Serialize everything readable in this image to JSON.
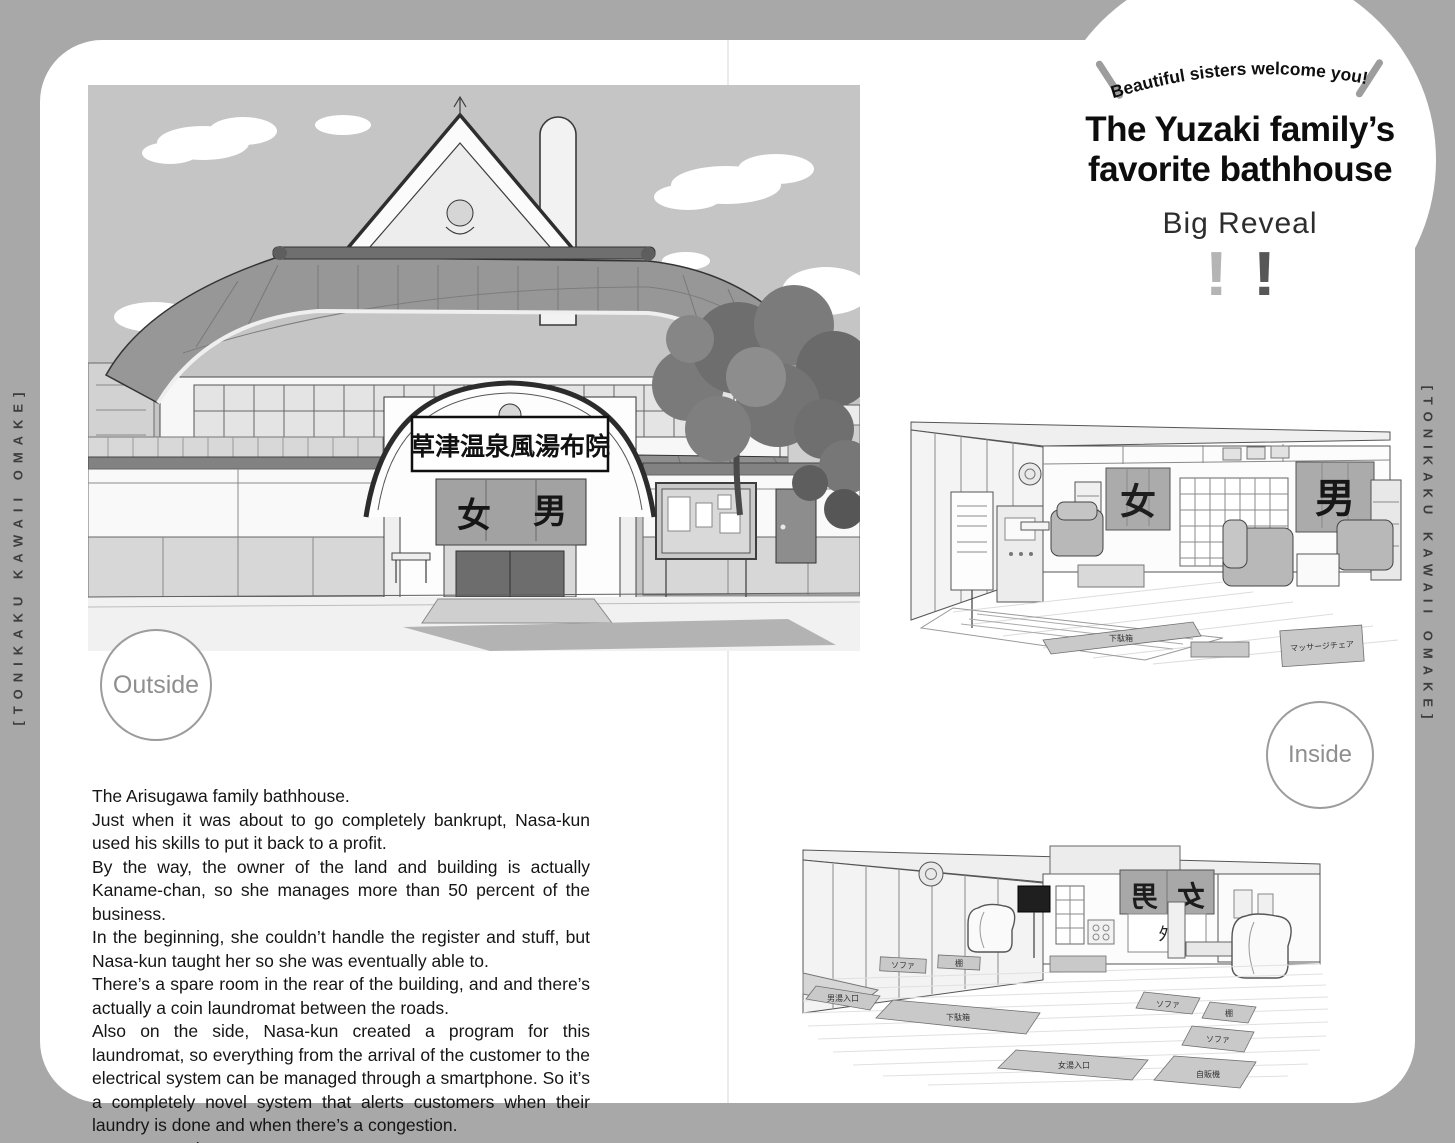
{
  "page": {
    "spine_left": "[TONIKAKU KAWAII OMAKE]",
    "spine_right": "[TONIKAKU KAWAII OMAKE]"
  },
  "header_badge": {
    "tagline": "Beautiful sisters welcome you!",
    "title_line1": "The Yuzaki family’s",
    "title_line2": "favorite bathhouse",
    "subtitle": "Big Reveal",
    "exclaim_left": "!",
    "exclaim_right": "!",
    "colors": {
      "exclaim_light": "#b4b4b4",
      "exclaim_dark": "#575757"
    }
  },
  "section_labels": {
    "outside": "Outside",
    "inside": "Inside"
  },
  "exterior_illustration": {
    "sign_text": "草津温泉風湯布院",
    "noren_left": "女",
    "noren_right": "男"
  },
  "interior_top_illustration": {
    "noren_left": "女",
    "noren_right": "男",
    "mat_label_geta": "下駄箱",
    "mat_label_massage": "マッサージチェア"
  },
  "interior_bottom_illustration": {
    "banner_left": "男",
    "banner_right": "女",
    "sign_center": "外",
    "mat_labels": {
      "sofa": "ソファ",
      "shelf": "棚",
      "vending": "自販機",
      "geta": "下駄箱",
      "women_entrance": "女湯入口",
      "men_entrance": "男湯入口"
    }
  },
  "body_text": {
    "paragraphs": [
      "The Arisugawa family bathhouse.",
      "Just when it was about to go completely bankrupt, Nasa-kun used his skills to put it back to a profit.",
      "By the way, the owner of the land and building is actually Kaname-chan, so she manages more than 50 percent of the business.",
      "In the beginning, she couldn’t handle the register and stuff, but Nasa-kun taught her so she was eventually able to.",
      "There’s a spare room in the rear of the building, and and there’s actually a coin laundromat between the roads.",
      "Also on the side, Nasa-kun created a program for this laundromat, so everything from the arrival of the customer to the electrical system can be managed through a smartphone. So it’s a completely novel system that alerts customers when their laundry is done and when there’s a congestion.",
      "It’s very popular."
    ]
  }
}
